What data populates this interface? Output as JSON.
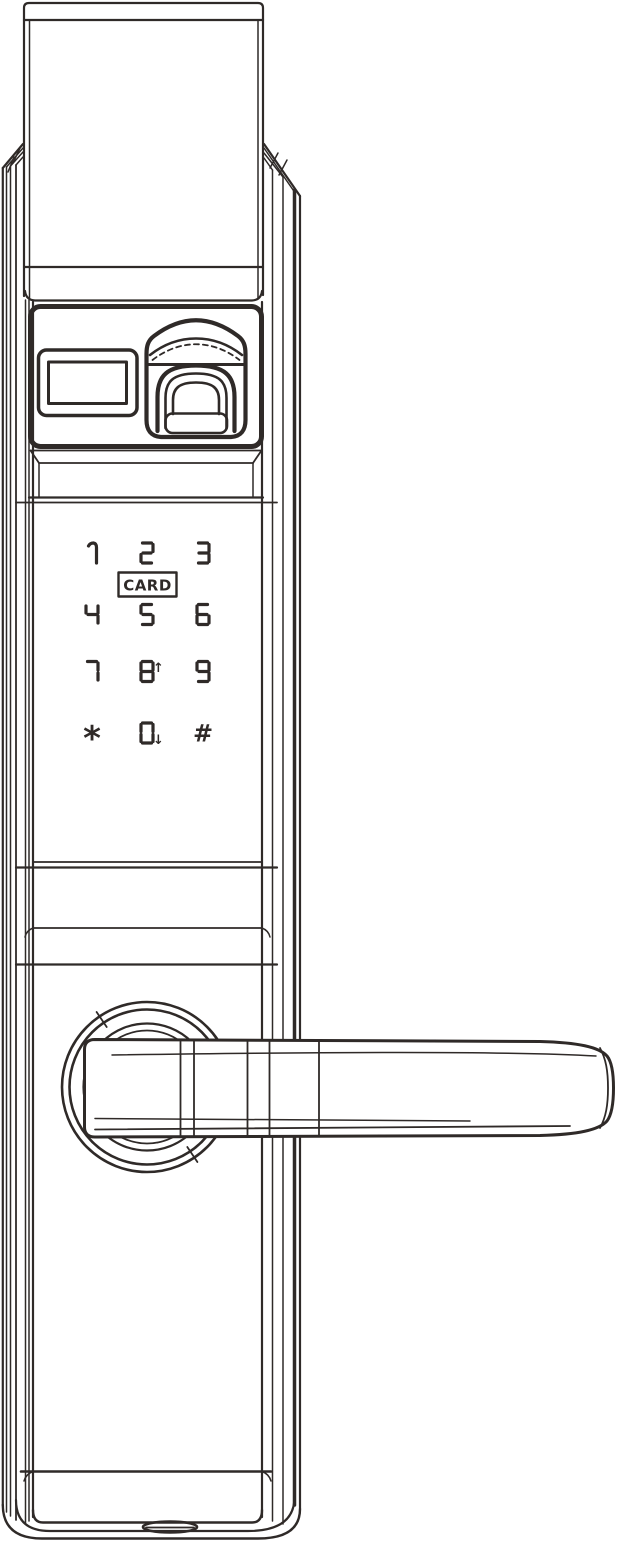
{
  "colors": {
    "line_color": "#2f2a28",
    "background": "#ffffff"
  },
  "keypad": {
    "card_label": "CARD",
    "rows": [
      [
        {
          "label": "1"
        },
        {
          "label": "2"
        },
        {
          "label": "3"
        }
      ],
      [
        {
          "label": "4"
        },
        {
          "label": "5"
        },
        {
          "label": "6"
        }
      ],
      [
        {
          "label": "7"
        },
        {
          "label": "8",
          "arrow": "up"
        },
        {
          "label": "9"
        }
      ],
      [
        {
          "label": "*"
        },
        {
          "label": "0",
          "arrow": "down"
        },
        {
          "label": "#"
        }
      ]
    ],
    "arrow_glyphs": {
      "up": "↑",
      "down": "↓"
    }
  }
}
